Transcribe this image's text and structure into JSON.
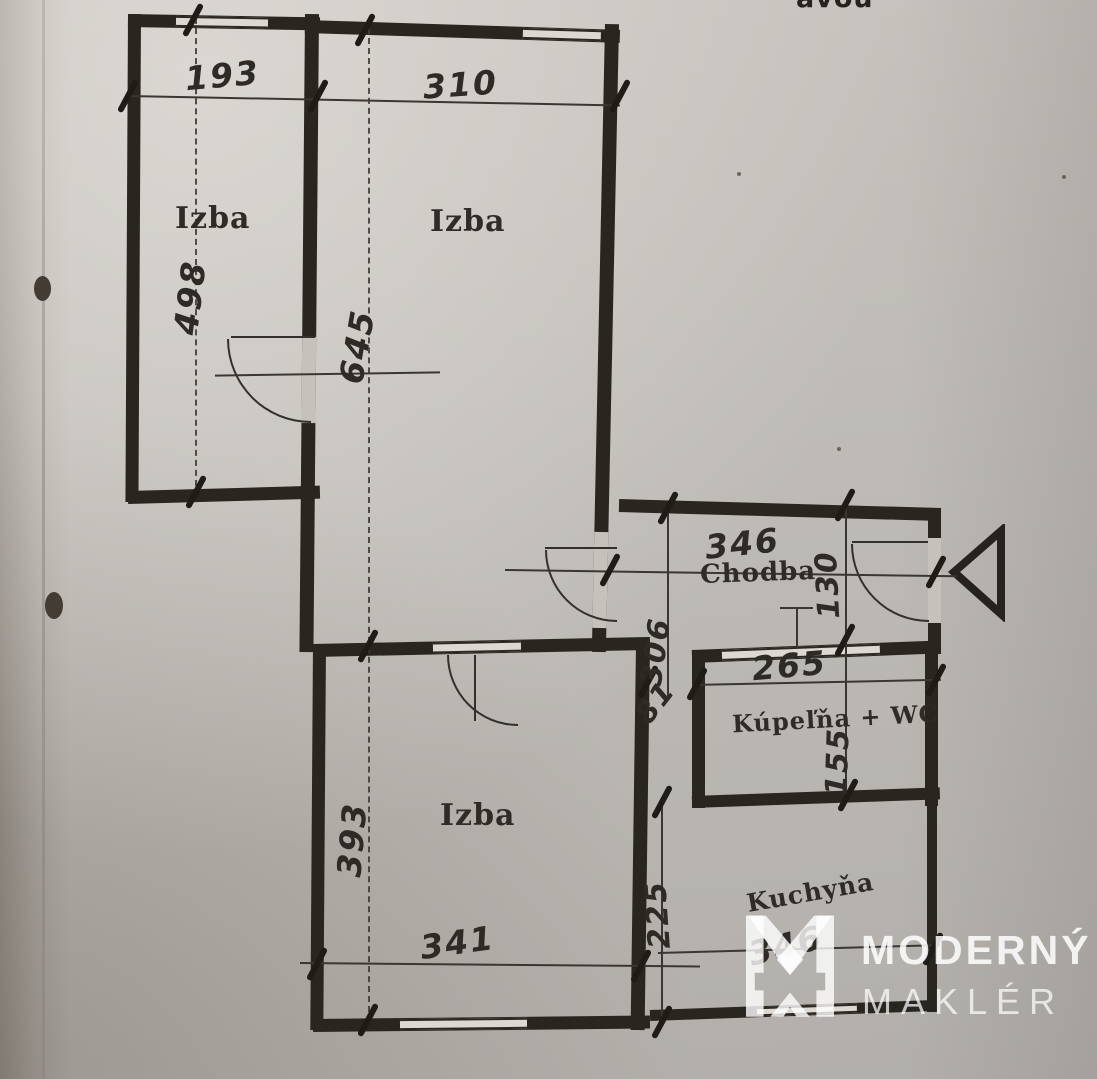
{
  "document": {
    "type_note": "scanned apartment floor plan",
    "partial_top_text": "avou"
  },
  "rooms": {
    "izba_left": "Izba",
    "izba_main": "Izba",
    "izba_bottom": "Izba",
    "chodba": "Chodba",
    "kupelna": "Kúpeľňa + WC",
    "kuchyna": "Kuchyňa"
  },
  "dims": {
    "izba_left_w": "193",
    "izba_main_w": "310",
    "izba_left_h": "498",
    "izba_main_h": "645",
    "chodba_w": "346",
    "chodba_h": "130",
    "hall_depth": "306",
    "kupelna_w": "265",
    "passage_w": "81",
    "kupelna_h": "155",
    "izba_bottom_h": "393",
    "izba_bottom_w": "341",
    "kuchyna_side": "225",
    "kuchyna_w": "346"
  },
  "watermark": {
    "brand": "MODERNÝ",
    "tagline": "MAKLÉR"
  },
  "colors": {
    "wall": "#29251f",
    "paper": "#bdbab5",
    "ink": "#2e2a25",
    "watermark": "#ffffff"
  }
}
